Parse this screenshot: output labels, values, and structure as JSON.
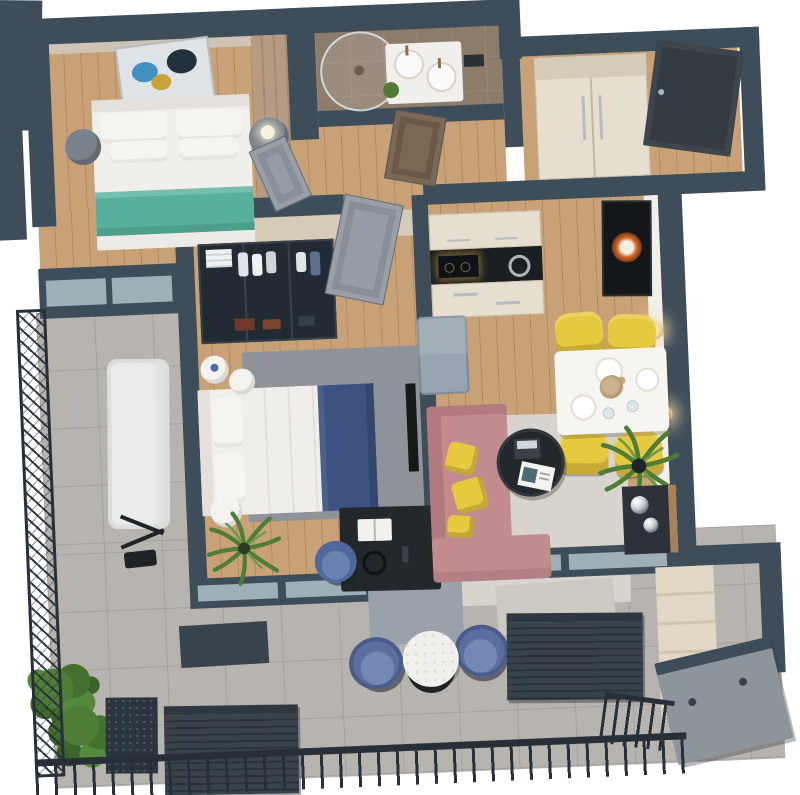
{
  "meta": {
    "description": "Top-down 3D isometric render of an apartment floor plan with wrap-around balcony",
    "view": "axonometric top view",
    "background": "#ffffff"
  },
  "palette": {
    "wall": "#3e4d5a",
    "rail": "#273039",
    "wood": "#c9a176",
    "wood_seam": "#b48a5e",
    "tile": "#b7b3af",
    "tile_seam": "#a5a19d",
    "bath_tile": "#8e7c6b",
    "cream": "#e6decf",
    "cream_dark": "#d6cbb8",
    "teal": "#57b09c",
    "navy": "#3e5282",
    "pink": "#c28b8e",
    "pink_dark": "#b27a7f",
    "yellow": "#e7c93f",
    "chair_blue": "#5a6ea0",
    "chair_blue_lt": "#7488b4",
    "desk_blue": "#50689f",
    "rug_gray": "#8d9399",
    "rug_light": "#d8d3cc",
    "mat": "#ccc9c3",
    "green": "#4e7d35",
    "green_dark": "#33591f",
    "black": "#23282d",
    "counter": "#1b1f23",
    "fridge": "#95a4b0",
    "door_dark": "#343b43",
    "door_gray": "#959ca6",
    "door_taupe": "#7d6753",
    "glass": "#a9bac2",
    "sconce": "#f0d49c",
    "lounger": "#ebecec",
    "slat_a": "#39434c",
    "slat_b": "#2b343c",
    "hatch": "#8d959c",
    "planter": "#2b3540",
    "white_soft": "#f1efec"
  },
  "rooms": {
    "bedroom1": {
      "name": "bedroom-1",
      "floor": "wood",
      "furniture": [
        "double-bed-teal-blanket",
        "nightstand-gray-left",
        "nightstand-gray-right-with-lamp",
        "abstract-wall-art",
        "wardrobe-panel",
        "balcony-glass-door"
      ]
    },
    "bathroom": {
      "name": "bathroom",
      "floor": "taupe-tile",
      "furniture": [
        "round-walk-in-shower",
        "vanity-with-two-round-basins",
        "decor-plant",
        "towel-rail-dark"
      ]
    },
    "hallway": {
      "name": "hallway",
      "floor": "wood",
      "furniture": [
        "bathroom-door-open-taupe"
      ]
    },
    "entrance": {
      "name": "entrance-hall",
      "floor": "wood",
      "furniture": [
        "built-in-wardrobe-cream",
        "entry-door-dark"
      ]
    },
    "bedroom2": {
      "name": "bedroom-2",
      "floor": "wood",
      "furniture": [
        "glass-front-wardrobe-with-clothes",
        "double-bed-navy-blanket",
        "round-nightstand-x2",
        "area-rug-gray",
        "black-desk",
        "open-book",
        "headphones",
        "desk-chair-blue",
        "palm-plant",
        "side-table-white",
        "wall-tv",
        "door-open-gray"
      ]
    },
    "kitchen": {
      "name": "kitchen",
      "floor": "wood",
      "furniture": [
        "upper-cabinets-cream",
        "black-counter-with-cooktop",
        "sink-ring",
        "drawer-cabinets",
        "refrigerator-gray"
      ]
    },
    "living_dining": {
      "name": "living-dining-room",
      "floor": "wood",
      "furniture": [
        "dining-table-white",
        "dining-chair-yellow-x4",
        "table-settings",
        "wall-art-orange",
        "wall-sconce-x2",
        "sofa-pink-l-shape",
        "yellow-pillow-x3",
        "coffee-table-round-black",
        "laptop",
        "magazine",
        "area-rug-light",
        "palm-plant-large",
        "sideboard-dark",
        "chrome-sphere-x2"
      ]
    },
    "balcony": {
      "name": "wrap-around-balcony",
      "floor": "gray-tile",
      "furniture": [
        "sun-lounger-white",
        "bistro-table-round",
        "balcony-armchair-blue-x2",
        "green-bush-planter",
        "louver-screen-x2",
        "flat-panel-dark",
        "storage-closet",
        "hatch-panel-gray",
        "door-mat",
        "black-railing"
      ]
    }
  }
}
